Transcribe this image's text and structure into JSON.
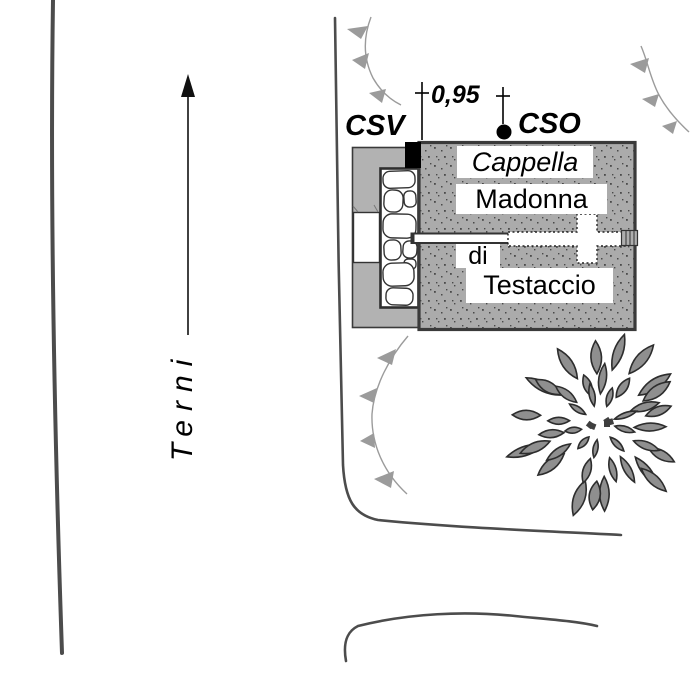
{
  "colors": {
    "road": "#4c4c4c",
    "outline": "#3a3a3a",
    "chapel_fill": "#ababab",
    "annex_fill": "#b2b2b2",
    "slope": "#9b9b9b",
    "leaf_fill": "#8f8f8f",
    "leaf_stroke": "#2d2d2d",
    "marker": "#000000",
    "label_bg": "#ffffff",
    "text": "#000000"
  },
  "labels": {
    "csv": "CSV",
    "cso": "CSO",
    "distance": "0,95",
    "chapel_line1": "Cappella",
    "chapel_line2": "Madonna",
    "chapel_line3": "di",
    "chapel_line4": "Testaccio",
    "direction": "Terni"
  },
  "tree": {
    "cx": 600,
    "cy": 424,
    "rings": [
      {
        "count": 19,
        "radius": 54,
        "length": 34,
        "width": 20
      },
      {
        "count": 13,
        "radius": 34,
        "length": 27,
        "width": 15
      },
      {
        "count": 9,
        "radius": 17,
        "length": 20,
        "width": 11
      }
    ],
    "core_bits": 5
  }
}
